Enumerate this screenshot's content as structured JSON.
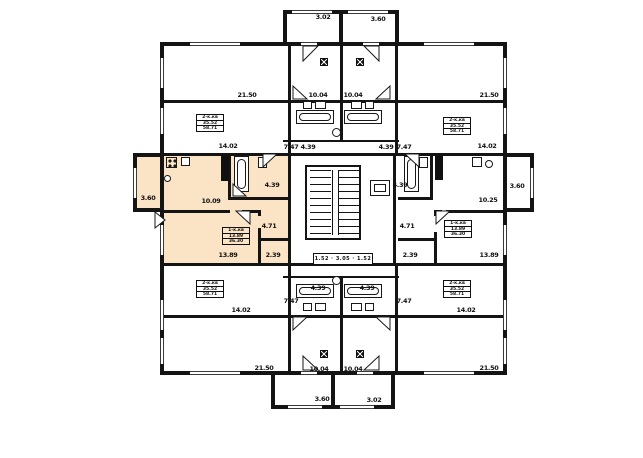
{
  "plan": {
    "type": "residential-floor-plan",
    "highlighted_unit": "middle-left-apartment",
    "colors": {
      "background": "#ffffff",
      "wall": "#141414",
      "highlight": "#fbe3c5",
      "text": "#101010"
    },
    "stair_plate": {
      "text": "1.52 · 3.05 · 1.52"
    },
    "area_labels": [
      {
        "t": "3.02",
        "x": 323,
        "y": 17
      },
      {
        "t": "3.60",
        "x": 378,
        "y": 19
      },
      {
        "t": "21.50",
        "x": 247,
        "y": 95
      },
      {
        "t": "10.04",
        "x": 318,
        "y": 95
      },
      {
        "t": "10.04",
        "x": 353,
        "y": 95
      },
      {
        "t": "21.50",
        "x": 489,
        "y": 95
      },
      {
        "t": "14.02",
        "x": 228,
        "y": 146
      },
      {
        "t": "7.47",
        "x": 291,
        "y": 147
      },
      {
        "t": "4.39",
        "x": 308,
        "y": 147
      },
      {
        "t": "4.39",
        "x": 386,
        "y": 147
      },
      {
        "t": "7.47",
        "x": 404,
        "y": 147
      },
      {
        "t": "14.02",
        "x": 487,
        "y": 146
      },
      {
        "t": "3.60",
        "x": 148,
        "y": 198
      },
      {
        "t": "10.09",
        "x": 211,
        "y": 201
      },
      {
        "t": "4.39",
        "x": 272,
        "y": 185
      },
      {
        "t": "4.71",
        "x": 269,
        "y": 226
      },
      {
        "t": "2.39",
        "x": 273,
        "y": 255
      },
      {
        "t": "13.89",
        "x": 228,
        "y": 255
      },
      {
        "t": "4.39",
        "x": 400,
        "y": 185
      },
      {
        "t": "10.25",
        "x": 488,
        "y": 200
      },
      {
        "t": "4.71",
        "x": 407,
        "y": 226
      },
      {
        "t": "2.39",
        "x": 410,
        "y": 255
      },
      {
        "t": "13.89",
        "x": 489,
        "y": 255
      },
      {
        "t": "3.60",
        "x": 517,
        "y": 186
      },
      {
        "t": "4.39",
        "x": 318,
        "y": 288
      },
      {
        "t": "4.39",
        "x": 367,
        "y": 288
      },
      {
        "t": "7.47",
        "x": 291,
        "y": 301
      },
      {
        "t": "7.47",
        "x": 404,
        "y": 301
      },
      {
        "t": "14.02",
        "x": 241,
        "y": 310
      },
      {
        "t": "14.02",
        "x": 466,
        "y": 310
      },
      {
        "t": "21.50",
        "x": 264,
        "y": 368
      },
      {
        "t": "10.04",
        "x": 319,
        "y": 369
      },
      {
        "t": "10.04",
        "x": 353,
        "y": 369
      },
      {
        "t": "21.50",
        "x": 489,
        "y": 368
      },
      {
        "t": "3.60",
        "x": 322,
        "y": 399
      },
      {
        "t": "3.02",
        "x": 374,
        "y": 400
      }
    ],
    "unit_plates": [
      {
        "x": 196,
        "y": 114,
        "w": 28,
        "h": 18,
        "hl": false,
        "lines": [
          "2-к.кв",
          "35.52",
          "58.71"
        ]
      },
      {
        "x": 443,
        "y": 117,
        "w": 28,
        "h": 18,
        "hl": false,
        "lines": [
          "2-к.кв",
          "35.52",
          "58.71"
        ]
      },
      {
        "x": 222,
        "y": 227,
        "w": 28,
        "h": 18,
        "hl": true,
        "lines": [
          "1-к.кв",
          "13.89",
          "36.30"
        ]
      },
      {
        "x": 444,
        "y": 220,
        "w": 28,
        "h": 18,
        "hl": false,
        "lines": [
          "1-к.кв",
          "13.89",
          "36.30"
        ]
      },
      {
        "x": 196,
        "y": 280,
        "w": 28,
        "h": 18,
        "hl": false,
        "lines": [
          "2-к.кв",
          "35.52",
          "58.71"
        ]
      },
      {
        "x": 443,
        "y": 280,
        "w": 28,
        "h": 18,
        "hl": false,
        "lines": [
          "2-к.кв",
          "35.52",
          "58.71"
        ]
      }
    ]
  }
}
